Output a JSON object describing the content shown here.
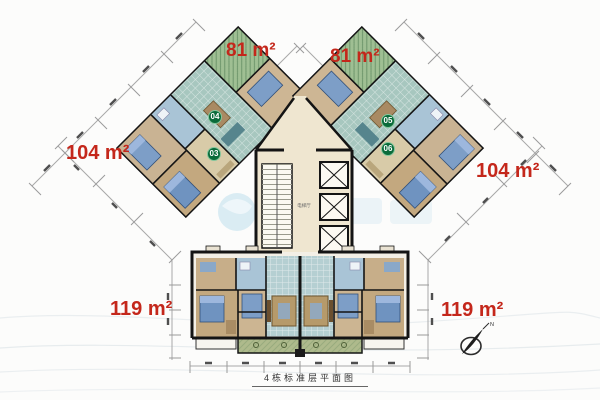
{
  "plan": {
    "caption": "4栋标准层平面图",
    "core_label": "电梯厅",
    "compass_north": "N"
  },
  "area_labels": {
    "top_left": "81 m²",
    "top_right": "81 m²",
    "mid_left": "104 m²",
    "mid_right": "104 m²",
    "bottom_left": "119 m²",
    "bottom_right": "119 m²"
  },
  "unit_badges": {
    "u04": "04",
    "u03": "03",
    "u05": "05",
    "u06": "06"
  },
  "colors": {
    "area_label_red": "#c4271b",
    "badge_green": "#0a6b3a",
    "badge_ring": "#83c69b",
    "wall_black": "#141414",
    "core_cream": "#efe6d0",
    "living_teal": "#a7c7bf",
    "living_blue": "#b5cfd2",
    "bedroom_tan": "#c3a87f",
    "balcony_green": "#9fbf93",
    "watermark_blue": "#8cc6e0"
  }
}
